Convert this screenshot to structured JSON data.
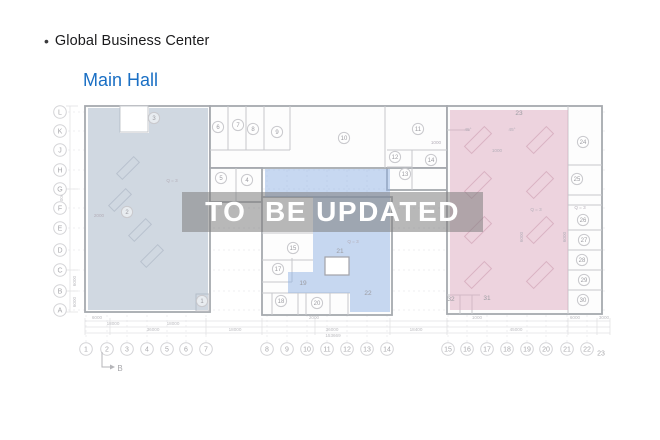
{
  "header": {
    "bullet": "•",
    "title": "Global Business Center",
    "subtitle": "Main Hall",
    "subtitle_color": "#1a6fc4"
  },
  "overlay": {
    "text": "TO  BE UPDATED"
  },
  "plan": {
    "colors": {
      "left_hall": "#a4b4c6",
      "center_hall": "#8fb2e4",
      "right_hall": "#ddaac0",
      "building_fill": "#fdfdfd",
      "outer_wall": "#a6a9ae",
      "inner_wall": "#c6c8cc",
      "grid_line": "#efeff1",
      "grid_stroke": "#d4d4d7",
      "grid_text": "#a8a8ac",
      "room_stroke": "#c9c9cd",
      "room_text": "#9c9ca2",
      "dim_line": "#e2e2e5",
      "dim_text": "#bcbcc0",
      "annot_text": "#b4aeb8"
    },
    "grid_rows": [
      {
        "label": "L",
        "y": 112
      },
      {
        "label": "K",
        "y": 131
      },
      {
        "label": "J",
        "y": 150
      },
      {
        "label": "H",
        "y": 170
      },
      {
        "label": "G",
        "y": 189
      },
      {
        "label": "F",
        "y": 208
      },
      {
        "label": "E",
        "y": 228
      },
      {
        "label": "D",
        "y": 250
      },
      {
        "label": "C",
        "y": 270
      },
      {
        "label": "B",
        "y": 291
      },
      {
        "label": "A",
        "y": 310
      }
    ],
    "grid_cols": [
      {
        "label": "1",
        "x": 86
      },
      {
        "label": "2",
        "x": 107
      },
      {
        "label": "3",
        "x": 127
      },
      {
        "label": "4",
        "x": 147
      },
      {
        "label": "5",
        "x": 167
      },
      {
        "label": "6",
        "x": 186
      },
      {
        "label": "7",
        "x": 206
      },
      {
        "label": "8",
        "x": 267
      },
      {
        "label": "9",
        "x": 287
      },
      {
        "label": "10",
        "x": 307
      },
      {
        "label": "11",
        "x": 327
      },
      {
        "label": "12",
        "x": 347
      },
      {
        "label": "13",
        "x": 367
      },
      {
        "label": "14",
        "x": 387
      },
      {
        "label": "15",
        "x": 448
      },
      {
        "label": "16",
        "x": 467
      },
      {
        "label": "17",
        "x": 487
      },
      {
        "label": "18",
        "x": 507
      },
      {
        "label": "19",
        "x": 527
      },
      {
        "label": "20",
        "x": 546
      },
      {
        "label": "21",
        "x": 567
      },
      {
        "label": "22",
        "x": 587
      }
    ],
    "grid_cols_y": 349,
    "grid_col_plain": {
      "label": "23",
      "x": 601,
      "y": 353
    },
    "rooms_circled": [
      {
        "n": "1",
        "x": 202,
        "y": 301
      },
      {
        "n": "2",
        "x": 127,
        "y": 212
      },
      {
        "n": "3",
        "x": 154,
        "y": 118
      },
      {
        "n": "4",
        "x": 247,
        "y": 180
      },
      {
        "n": "5",
        "x": 221,
        "y": 178
      },
      {
        "n": "6",
        "x": 218,
        "y": 127
      },
      {
        "n": "7",
        "x": 238,
        "y": 125
      },
      {
        "n": "8",
        "x": 253,
        "y": 129
      },
      {
        "n": "9",
        "x": 277,
        "y": 132
      },
      {
        "n": "10",
        "x": 344,
        "y": 138
      },
      {
        "n": "11",
        "x": 418,
        "y": 129
      },
      {
        "n": "12",
        "x": 395,
        "y": 157
      },
      {
        "n": "13",
        "x": 405,
        "y": 174
      },
      {
        "n": "14",
        "x": 431,
        "y": 160
      },
      {
        "n": "15",
        "x": 293,
        "y": 248
      },
      {
        "n": "17",
        "x": 278,
        "y": 269
      },
      {
        "n": "18",
        "x": 281,
        "y": 301
      },
      {
        "n": "20",
        "x": 317,
        "y": 303
      },
      {
        "n": "24",
        "x": 583,
        "y": 142
      },
      {
        "n": "25",
        "x": 577,
        "y": 179
      },
      {
        "n": "26",
        "x": 583,
        "y": 220
      },
      {
        "n": "27",
        "x": 584,
        "y": 240
      },
      {
        "n": "28",
        "x": 582,
        "y": 260
      },
      {
        "n": "29",
        "x": 584,
        "y": 280
      },
      {
        "n": "30",
        "x": 583,
        "y": 300
      }
    ],
    "rooms_plain": [
      {
        "n": "19",
        "x": 303,
        "y": 283
      },
      {
        "n": "21",
        "x": 340,
        "y": 251
      },
      {
        "n": "22",
        "x": 368,
        "y": 293
      },
      {
        "n": "23",
        "x": 519,
        "y": 113
      },
      {
        "n": "31",
        "x": 487,
        "y": 298
      },
      {
        "n": "32",
        "x": 451,
        "y": 299
      }
    ],
    "annotations": [
      {
        "text": "Q = 3",
        "x": 172,
        "y": 182,
        "rot": 0
      },
      {
        "text": "2000",
        "x": 99,
        "y": 217,
        "rot": 0
      },
      {
        "text": "Q = 3",
        "x": 353,
        "y": 243,
        "rot": 0
      },
      {
        "text": "Q = 3",
        "x": 536,
        "y": 211,
        "rot": 0
      },
      {
        "text": "Q = 3",
        "x": 580,
        "y": 209,
        "rot": 0
      },
      {
        "text": "1000",
        "x": 436,
        "y": 144,
        "rot": 0
      },
      {
        "text": "1000",
        "x": 497,
        "y": 152,
        "rot": 0
      },
      {
        "text": "45°",
        "x": 468,
        "y": 131,
        "rot": 0
      },
      {
        "text": "45°",
        "x": 512,
        "y": 131,
        "rot": 0
      },
      {
        "text": "6000",
        "x": 523,
        "y": 237,
        "rot": -90
      },
      {
        "text": "6000",
        "x": 566,
        "y": 237,
        "rot": -90
      }
    ],
    "dimensions_h": [
      {
        "text": "6000",
        "x": 97,
        "y": 319
      },
      {
        "text": "18000",
        "x": 113,
        "y": 325
      },
      {
        "text": "36000",
        "x": 153,
        "y": 331
      },
      {
        "text": "18000",
        "x": 173,
        "y": 325
      },
      {
        "text": "18000",
        "x": 235,
        "y": 331
      },
      {
        "text": "2000",
        "x": 314,
        "y": 319
      },
      {
        "text": "36000",
        "x": 332,
        "y": 331
      },
      {
        "text": "153669",
        "x": 333,
        "y": 337
      },
      {
        "text": "18400",
        "x": 416,
        "y": 331
      },
      {
        "text": "1000",
        "x": 477,
        "y": 319
      },
      {
        "text": "45000",
        "x": 516,
        "y": 331
      },
      {
        "text": "6000",
        "x": 575,
        "y": 319
      },
      {
        "text": "3000",
        "x": 604,
        "y": 319
      }
    ],
    "dimensions_v": [
      {
        "text": "60000",
        "x": 63,
        "y": 200
      },
      {
        "text": "6000",
        "x": 76,
        "y": 281
      },
      {
        "text": "6000",
        "x": 76,
        "y": 302
      }
    ],
    "section_marker": {
      "label": "B"
    }
  }
}
